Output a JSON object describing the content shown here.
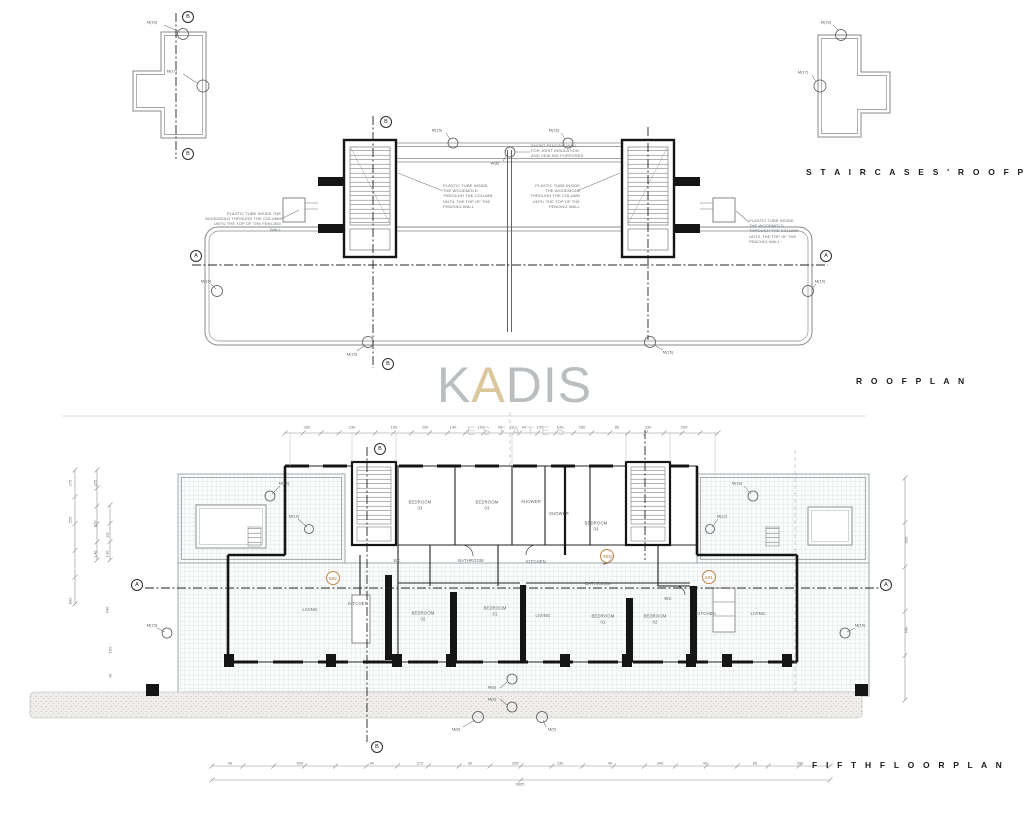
{
  "titles": {
    "staircases_roof_plan": "S T A I R C A S E S '   R O O F   P L A N",
    "roof_plan": "R O O F   P L A N",
    "fifth_floor_plan": "F I F T H   F L O O R   P L A N"
  },
  "watermark": {
    "part1": "K",
    "part2": "A",
    "part3": "DIS",
    "subtitle": "ESTATES"
  },
  "notes": {
    "plastic_tube": "PLASTIC TUBE INSIDE THE WOODMOLD THROUGH THE COLUMN UNTIL THE TOP OF THE FENCING WALL",
    "short_fencing": "SHORT FENCING WALL FOR JOINT INSULATION AND SEALING PURPOSES"
  },
  "section_markers": [
    {
      "x": 188,
      "y": 17,
      "t": "B"
    },
    {
      "x": 188,
      "y": 154,
      "t": "B"
    },
    {
      "x": 386,
      "y": 122,
      "t": "B"
    },
    {
      "x": 388,
      "y": 364,
      "t": "B"
    },
    {
      "x": 196,
      "y": 256,
      "t": "A"
    },
    {
      "x": 826,
      "y": 256,
      "t": "A"
    },
    {
      "x": 137,
      "y": 585,
      "t": "A"
    },
    {
      "x": 886,
      "y": 585,
      "t": "A"
    },
    {
      "x": 380,
      "y": 449,
      "t": "B"
    },
    {
      "x": 377,
      "y": 747,
      "t": "B"
    }
  ],
  "marker_labels": [
    {
      "x": 152,
      "y": 22,
      "t": "M(16)"
    },
    {
      "x": 172,
      "y": 71,
      "t": "M(17)"
    },
    {
      "x": 826,
      "y": 22,
      "t": "M(16)"
    },
    {
      "x": 803,
      "y": 72,
      "t": "M(17)"
    },
    {
      "x": 437,
      "y": 130,
      "t": "M(15)"
    },
    {
      "x": 554,
      "y": 130,
      "t": "M(15)"
    },
    {
      "x": 495,
      "y": 163,
      "t": "W(6)"
    },
    {
      "x": 206,
      "y": 281,
      "t": "M(15)"
    },
    {
      "x": 820,
      "y": 281,
      "t": "M(15)"
    },
    {
      "x": 352,
      "y": 354,
      "t": "M(15)"
    },
    {
      "x": 668,
      "y": 352,
      "t": "M(15)"
    },
    {
      "x": 284,
      "y": 483,
      "t": "M(16)"
    },
    {
      "x": 737,
      "y": 483,
      "t": "M(16)"
    },
    {
      "x": 294,
      "y": 516,
      "t": "M(12)"
    },
    {
      "x": 722,
      "y": 516,
      "t": "M(12)"
    },
    {
      "x": 152,
      "y": 625,
      "t": "M(15)"
    },
    {
      "x": 860,
      "y": 625,
      "t": "M(15)"
    },
    {
      "x": 492,
      "y": 687,
      "t": "M(6)"
    },
    {
      "x": 492,
      "y": 699,
      "t": "M(3)"
    },
    {
      "x": 456,
      "y": 729,
      "t": "M(8)"
    },
    {
      "x": 552,
      "y": 729,
      "t": "M(5)"
    }
  ],
  "room_labels": [
    {
      "x": 420,
      "y": 505,
      "t": "BEDROOM\n03"
    },
    {
      "x": 487,
      "y": 505,
      "t": "BEDROOM\n03"
    },
    {
      "x": 531,
      "y": 502,
      "t": "SHOWER"
    },
    {
      "x": 559,
      "y": 514,
      "t": "SHOWER"
    },
    {
      "x": 596,
      "y": 526,
      "t": "BEDROOM\n03"
    },
    {
      "x": 397,
      "y": 561,
      "t": "WC"
    },
    {
      "x": 471,
      "y": 561,
      "t": "BATHROOM"
    },
    {
      "x": 536,
      "y": 562,
      "t": "KITCHEN"
    },
    {
      "x": 598,
      "y": 584,
      "t": "BATHROOM"
    },
    {
      "x": 310,
      "y": 610,
      "t": "LIVING"
    },
    {
      "x": 358,
      "y": 604,
      "t": "KITCHEN"
    },
    {
      "x": 423,
      "y": 616,
      "t": "BEDROOM\n02"
    },
    {
      "x": 495,
      "y": 611,
      "t": "BEDROOM\n01"
    },
    {
      "x": 543,
      "y": 616,
      "t": "LIVING"
    },
    {
      "x": 603,
      "y": 619,
      "t": "BEDROOM\n01"
    },
    {
      "x": 655,
      "y": 619,
      "t": "BEDROOM\n02"
    },
    {
      "x": 668,
      "y": 599,
      "t": "WC"
    },
    {
      "x": 706,
      "y": 614,
      "t": "KITCHEN"
    },
    {
      "x": 758,
      "y": 614,
      "t": "LIVING"
    }
  ],
  "unit_numbers": [
    {
      "x": 333,
      "y": 578,
      "t": "502"
    },
    {
      "x": 607,
      "y": 556,
      "t": "503"
    },
    {
      "x": 709,
      "y": 577,
      "t": "501"
    }
  ],
  "dimensions": {
    "top": [
      {
        "x": 307,
        "y": 427,
        "t": "280"
      },
      {
        "x": 352,
        "y": 427,
        "t": "230"
      },
      {
        "x": 394,
        "y": 427,
        "t": "150"
      },
      {
        "x": 425,
        "y": 427,
        "t": "230"
      },
      {
        "x": 453,
        "y": 427,
        "t": "140"
      },
      {
        "x": 481,
        "y": 427,
        "t": "105"
      },
      {
        "x": 500,
        "y": 427,
        "t": "40"
      },
      {
        "x": 512,
        "y": 427,
        "t": "16"
      },
      {
        "x": 524,
        "y": 427,
        "t": "40"
      },
      {
        "x": 540,
        "y": 427,
        "t": "105"
      },
      {
        "x": 560,
        "y": 427,
        "t": "140"
      },
      {
        "x": 582,
        "y": 427,
        "t": "250"
      },
      {
        "x": 617,
        "y": 427,
        "t": "85"
      },
      {
        "x": 648,
        "y": 427,
        "t": "230"
      },
      {
        "x": 684,
        "y": 427,
        "t": "200"
      }
    ],
    "left": [
      {
        "x": 70,
        "y": 483,
        "t": "275",
        "r": 1
      },
      {
        "x": 95,
        "y": 483,
        "t": "275",
        "r": 1
      },
      {
        "x": 70,
        "y": 520,
        "t": "255",
        "r": 1
      },
      {
        "x": 95,
        "y": 524,
        "t": "170",
        "r": 1
      },
      {
        "x": 107,
        "y": 535,
        "t": "111",
        "r": 1
      },
      {
        "x": 95,
        "y": 554,
        "t": "140",
        "r": 1
      },
      {
        "x": 107,
        "y": 554,
        "t": "140",
        "r": 1
      },
      {
        "x": 70,
        "y": 601,
        "t": "800",
        "r": 1
      },
      {
        "x": 107,
        "y": 610,
        "t": "640",
        "r": 1
      },
      {
        "x": 110,
        "y": 650,
        "t": "150",
        "r": 1
      },
      {
        "x": 110,
        "y": 676,
        "t": "40",
        "r": 1
      }
    ],
    "right": [
      {
        "x": 906,
        "y": 540,
        "t": "800",
        "r": 1
      },
      {
        "x": 906,
        "y": 630,
        "t": "640",
        "r": 1
      }
    ],
    "bottom": [
      {
        "x": 230,
        "y": 763,
        "t": "40"
      },
      {
        "x": 300,
        "y": 763,
        "t": "600"
      },
      {
        "x": 372,
        "y": 763,
        "t": "40"
      },
      {
        "x": 420,
        "y": 763,
        "t": "270"
      },
      {
        "x": 470,
        "y": 763,
        "t": "30"
      },
      {
        "x": 515,
        "y": 763,
        "t": "305"
      },
      {
        "x": 560,
        "y": 763,
        "t": "230"
      },
      {
        "x": 610,
        "y": 763,
        "t": "40"
      },
      {
        "x": 660,
        "y": 763,
        "t": "340"
      },
      {
        "x": 705,
        "y": 763,
        "t": "40"
      },
      {
        "x": 755,
        "y": 763,
        "t": "85"
      },
      {
        "x": 800,
        "y": 763,
        "t": "200"
      },
      {
        "x": 520,
        "y": 784,
        "t": "3605"
      }
    ]
  },
  "colors": {
    "accent_tan": "#d6c294",
    "watermark_gray": "#b4b8bb",
    "unit_badge": "#c08445",
    "line_gray": "#9aa0a4",
    "wall_black": "#151515"
  }
}
